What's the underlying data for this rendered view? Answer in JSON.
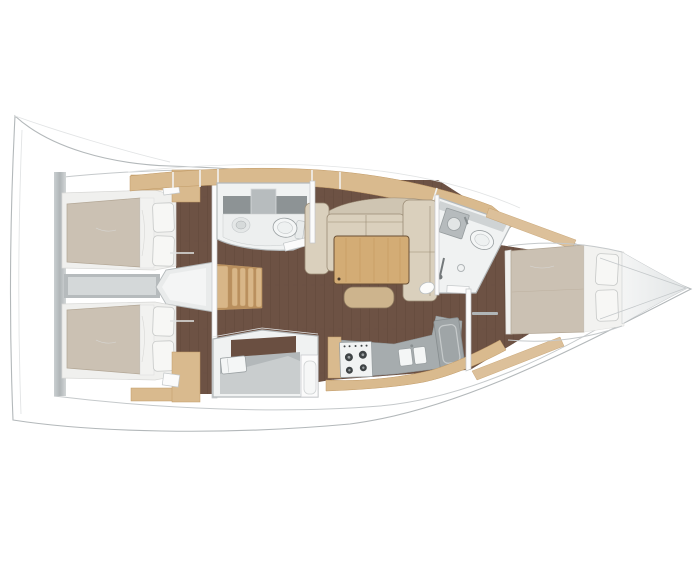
{
  "meta": {
    "kind": "yacht-interior-floor-plan",
    "orientation": "bow-right",
    "canvas": {
      "width": 700,
      "height": 576
    },
    "background": "#ffffff"
  },
  "palette": {
    "hull_outline": "#b3b8ba",
    "deck_line": "#c5c9cb",
    "deck_faint": "#e2e4e5",
    "floor_wood": "#6d5244",
    "floor_plank": "#5b4337",
    "walnut_band": "#6a4f41",
    "oak": "#d9ba8e",
    "oak_edge": "#c19a66",
    "oak_light": "#dcc09a",
    "stair_base": "#b98f5e",
    "stair_tread": "#d8b688",
    "mattress": "#cbc1b3",
    "mattress_edge": "#b3a796",
    "linen": "#f2f2f0",
    "pillow": "#f7f7f5",
    "pillow_edge": "#c6c8c7",
    "platform": "#f0f0ee",
    "platform_edge": "#d8d8d6",
    "sofa": "#dad0bd",
    "sofa_back": "#cfc5b2",
    "sofa_edge": "#9a8b75",
    "table_wood": "#d3ac75",
    "table_edge": "#6b5136",
    "table_grain": "#c79d62",
    "stool": "#cdb48d",
    "stool_edge": "#8a765c",
    "counter": "#a6acae",
    "counter_dark": "#8d9395",
    "counter_light": "#c9cdce",
    "fixture": "#f4f6f6",
    "fixture_dim": "#e4e7e7",
    "fixture_edge": "#9aa0a2",
    "wall_fill": "#f0f2f2",
    "wall_edge": "#b4b9bb",
    "white_panel": "#fbfbfb",
    "panel_edge": "#c3c7c9",
    "bulkhead": "#b7bcbe",
    "bulkhead_light": "#d6dadb",
    "engine": "#b6bbbd",
    "engine_light": "#d4d8d9",
    "vestibule": "#e9ebeb",
    "burner": "#3f4446",
    "bow_light": "#f4f5f5",
    "bow_dark": "#e2e5e6"
  },
  "layout": {
    "rooms": [
      {
        "name": "aft-cabin-upper",
        "features": [
          "double-berth",
          "2-pillows",
          "wardrobe",
          "entry-floor"
        ]
      },
      {
        "name": "aft-cabin-lower",
        "features": [
          "double-berth",
          "2-pillows",
          "wardrobe",
          "entry-floor"
        ]
      },
      {
        "name": "companionway",
        "features": [
          "wood-stairs-4-treads",
          "engine-compartment"
        ]
      },
      {
        "name": "head-upper",
        "features": [
          "washbasin",
          "toilet",
          "mirror-cabinet",
          "counter"
        ]
      },
      {
        "name": "salon",
        "features": [
          "l-shaped-sofa",
          "wood-table",
          "stool",
          "deco-object"
        ]
      },
      {
        "name": "galley",
        "features": [
          "stove-4-burner",
          "double-sink",
          "refrigerator",
          "counter"
        ]
      },
      {
        "name": "head-lower",
        "features": [
          "washbasin",
          "shower-counter",
          "door-panel"
        ]
      },
      {
        "name": "head-forward",
        "features": [
          "washbasin",
          "toilet",
          "shower-drain",
          "shower-wand"
        ]
      },
      {
        "name": "forward-cabin",
        "features": [
          "island-double-berth",
          "2-pillows",
          "door"
        ]
      },
      {
        "name": "bow",
        "features": [
          "anchor-locker"
        ]
      }
    ],
    "counts": {
      "cabins": 3,
      "heads": 3,
      "berth_pillows": 6,
      "stove_burners": 4,
      "stair_treads": 4
    }
  }
}
